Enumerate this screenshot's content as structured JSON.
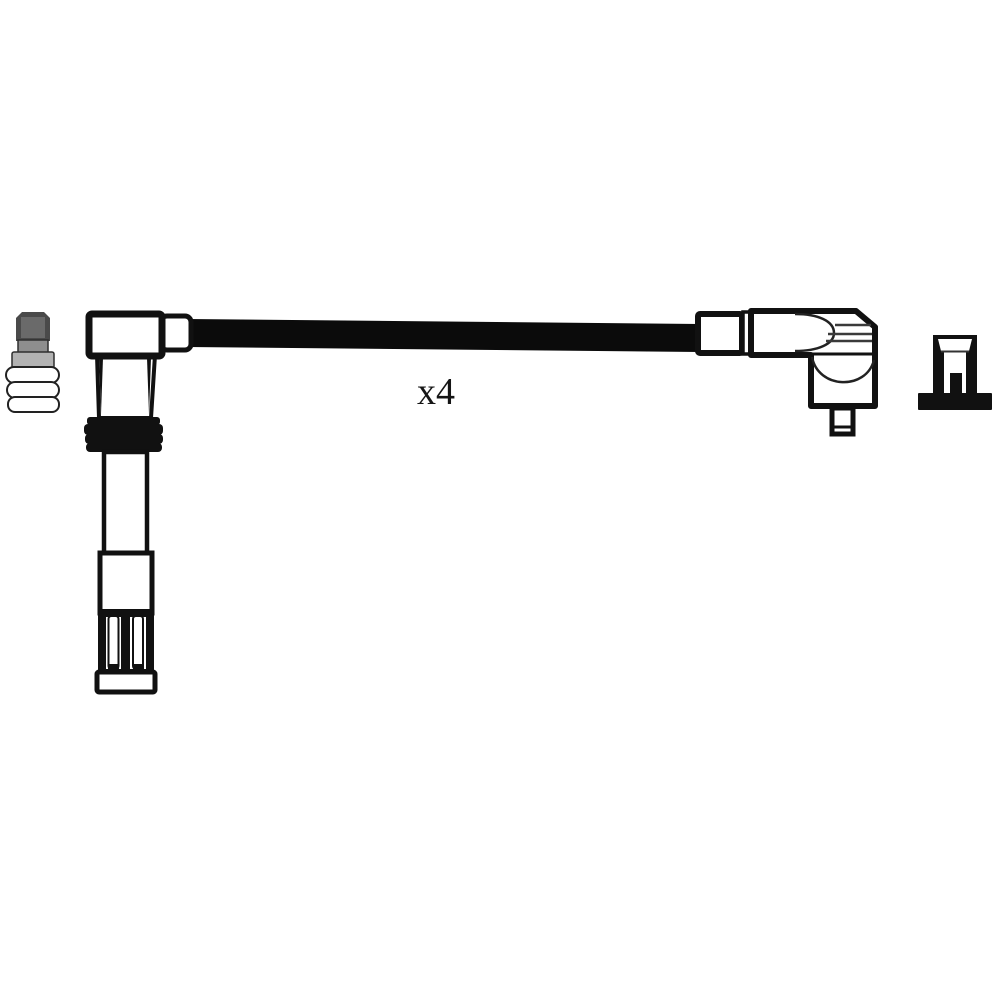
{
  "image": {
    "type": "product-line-drawing",
    "subject": "Ignition cable / spark plug wire set",
    "background": "#ffffff"
  },
  "label": {
    "quantity": "x4"
  },
  "colors": {
    "line": "#111111",
    "cable": "#0b0b0b",
    "white": "#ffffff",
    "plug_cap_dark": "#4a4a4a",
    "plug_cap_face": "#6a6a6a",
    "plug_hex": "#8e8e8e",
    "plug_shoulder": "#b2b2b2",
    "silhouette": "#111111"
  },
  "icons": {
    "left_small": "spark-plug-terminal-icon",
    "left_connector": "spark-plug-boot",
    "cable": "ignition-cable",
    "right_connector": "elbow-connector",
    "right_small": "coil-socket-icon"
  }
}
